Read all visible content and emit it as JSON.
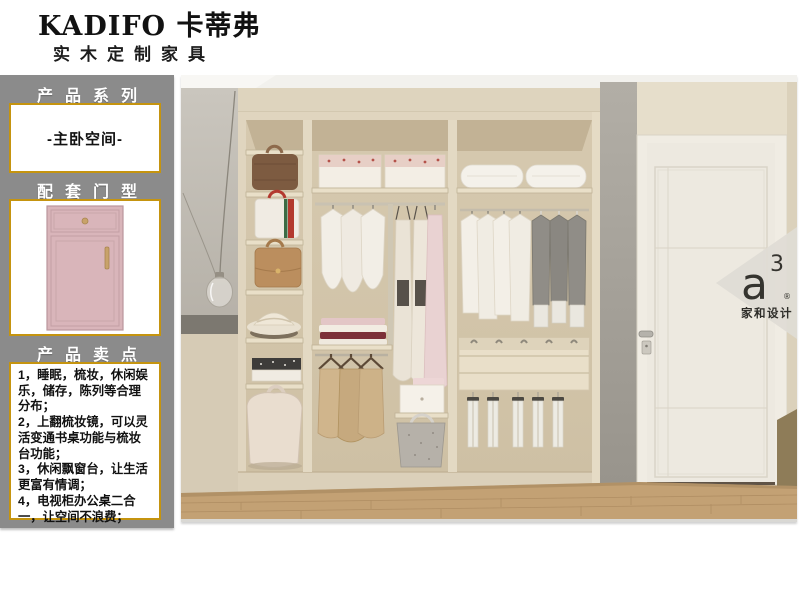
{
  "brand": {
    "title": "KADIFO 卡蒂弗",
    "subtitle": "实木定制家具"
  },
  "sidebar": {
    "bg_color": "#8b8b8b",
    "accent_color": "#c5940f",
    "series": {
      "heading": "产品系列",
      "value": "-主卧空间-"
    },
    "door_type": {
      "heading": "配套门型",
      "door_color": "#d9b5ba"
    },
    "selling_points": {
      "heading": "产品卖点",
      "points": [
        "1，睡眠，梳妆，休闲娱乐，储存，陈列等合理分布；",
        "2，上翻梳妆镜，可以灵活变通书桌功能与梳妆台功能；",
        "3，休闲飘窗台，让生活更富有情调；",
        "4，电视柜办公桌二合一，让空间不浪费；"
      ]
    }
  },
  "watermark": {
    "logo": "a",
    "sup": "3",
    "registered": "®",
    "caption": "家和设计"
  }
}
